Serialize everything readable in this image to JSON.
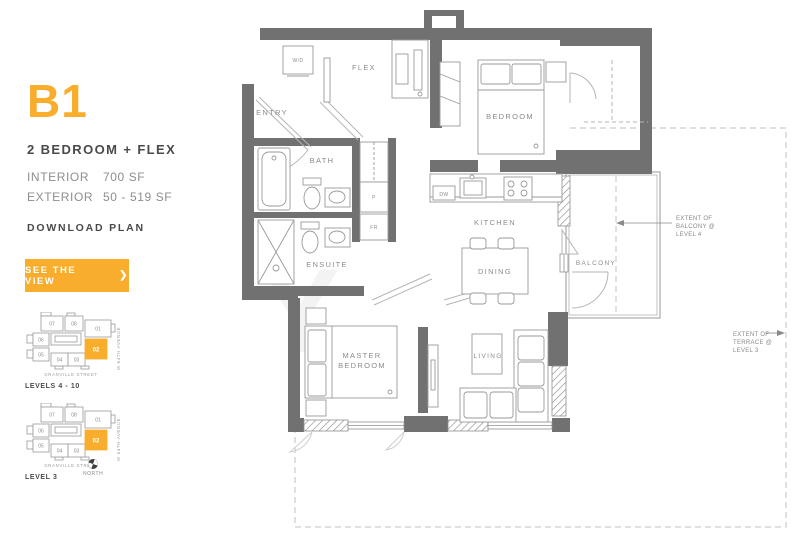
{
  "sidebar": {
    "plan_code": "B1",
    "plan_name": "2 BEDROOM + FLEX",
    "specs": [
      {
        "label": "INTERIOR",
        "value": "700 SF"
      },
      {
        "label": "EXTERIOR",
        "value": "50 - 519 SF"
      }
    ],
    "download_label": "DOWNLOAD PLAN",
    "cta": {
      "label": "SEE THE VIEW",
      "chevron": "❯"
    },
    "accent_color": "#F8AE2C"
  },
  "keyplans": [
    {
      "caption": "LEVELS 4 - 10",
      "street": "GRANVILLE STREET",
      "avenue": "W 64TH AVENUE",
      "highlighted_unit": "02",
      "units": [
        "07",
        "08",
        "01",
        "06",
        "05",
        "04",
        "03",
        "02"
      ]
    },
    {
      "caption": "LEVEL 3",
      "street": "GRANVILLE STREET",
      "avenue": "W 64TH AVENUE",
      "highlighted_unit": "02",
      "north_label": "NORTH",
      "units": [
        "07",
        "08",
        "01",
        "06",
        "05",
        "04",
        "03",
        "02"
      ]
    }
  ],
  "floorplan": {
    "watermark": "Y",
    "wall_color": "#717171",
    "rooms": {
      "entry": "ENTRY",
      "wd": "W/D",
      "flex": "FLEX",
      "bedroom": "BEDROOM",
      "bath": "BATH",
      "pantry": "P",
      "fridge": "FR",
      "ensuite": "ENSUITE",
      "kitchen": "KITCHEN",
      "dw": "DW",
      "dining": "DINING",
      "balcony": "BALCONY",
      "master_line1": "MASTER",
      "master_line2": "BEDROOM",
      "living": "LIVING"
    },
    "annotations": {
      "balcony_extent": [
        "EXTENT OF",
        "BALCONY @",
        "LEVEL 4"
      ],
      "terrace_extent": [
        "EXTENT OF",
        "TERRACE @",
        "LEVEL 3"
      ]
    }
  }
}
